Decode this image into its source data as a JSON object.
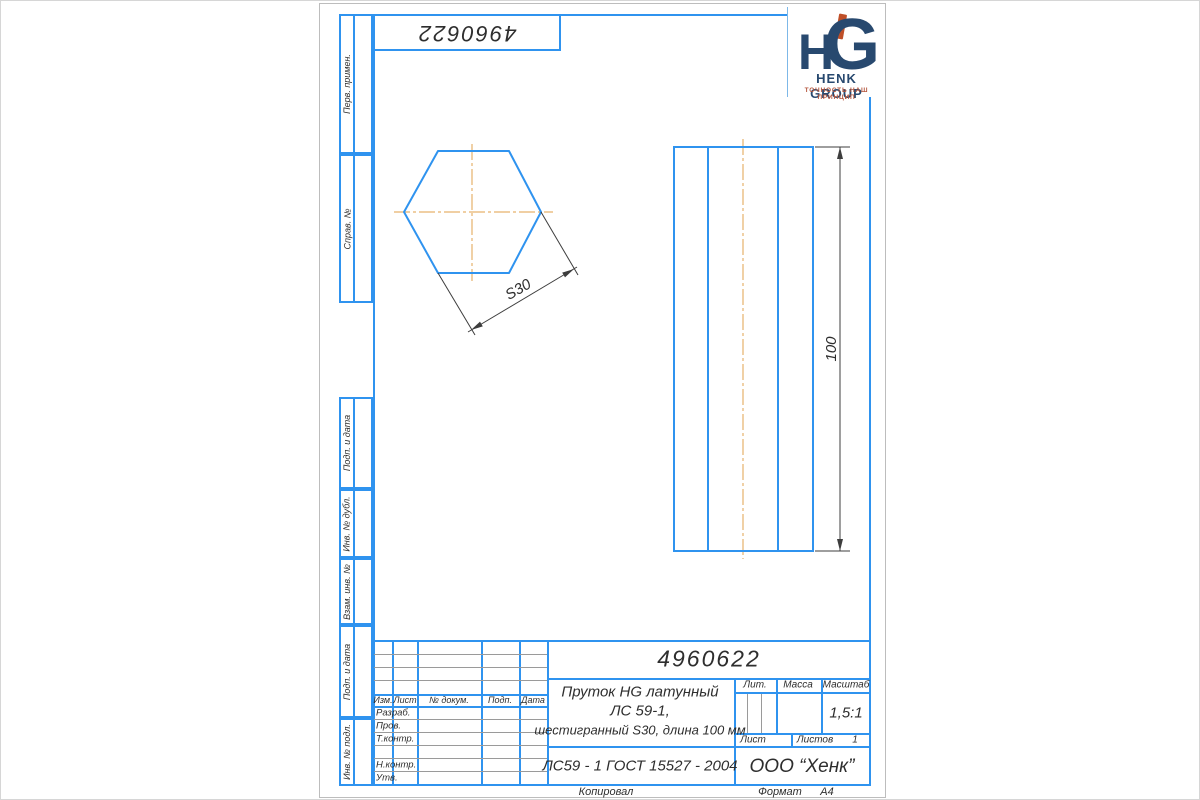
{
  "page": {
    "top_number": "4960622"
  },
  "logo": {
    "monogram_left": "H",
    "monogram_right": "G",
    "company": "HENK GROUP",
    "tagline": "ТОЧНОСТЬ НАШ ПРИНЦИП"
  },
  "margin_labels": [
    "Перв. примен.",
    "Справ. №",
    "Подп. и дата",
    "Инв. № дубл.",
    "Взам. инв. №",
    "Подп. и дата",
    "Инв. № подл."
  ],
  "drawing": {
    "dim_across_flats": "S30",
    "dim_length": "100"
  },
  "title_block": {
    "doc_number": "4960622",
    "name_line1": "Пруток HG латунный",
    "name_line2": "ЛС 59-1,",
    "name_line3": "шестигранный S30, длина 100 мм",
    "material": "ЛС59 - 1 ГОСТ 15527 - 2004",
    "company": "ООО “Хенк”",
    "columns": [
      "Изм.",
      "Лист",
      "№ докум.",
      "Подп.",
      "Дата"
    ],
    "rows": [
      "Разраб.",
      "Пров.",
      "Т.контр.",
      "Н.контр.",
      "Утв."
    ],
    "lit_label": "Лит.",
    "mass_label": "Масса",
    "scale_label": "Масштаб",
    "scale_value": "1,5:1",
    "sheet_label": "Лист",
    "sheets_label": "Листов",
    "sheets_value": "1"
  },
  "footer": {
    "copied_by": "Копировал",
    "format_label": "Формат",
    "format_value": "А4"
  },
  "colors": {
    "frame_blue": "#2f93ef",
    "centerline_orange": "#e7b26c",
    "dimension_dark": "#3d3d3d",
    "logo_navy": "#28496f",
    "logo_red": "#bf4f28"
  }
}
